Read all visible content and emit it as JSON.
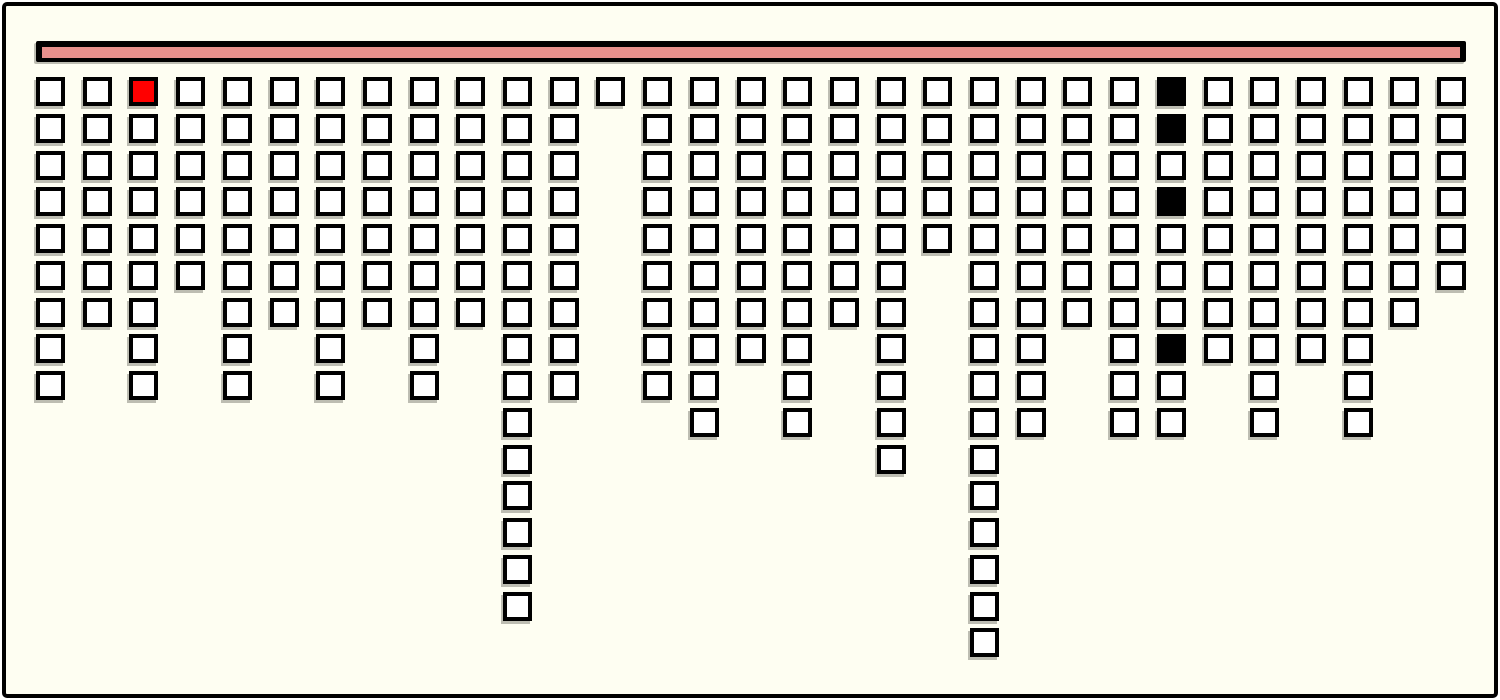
{
  "canvas": {
    "outer_background": "#FFFFFF",
    "panel_background": "#FEFEF2",
    "panel_border_color": "#000000"
  },
  "top_bar": {
    "fill_color": "#E8908C",
    "border_color": "#000000"
  },
  "grid": {
    "columns": 31,
    "max_rows": 16,
    "column_heights": [
      9,
      7,
      9,
      6,
      9,
      7,
      9,
      7,
      9,
      7,
      15,
      9,
      1,
      9,
      10,
      8,
      10,
      7,
      11,
      5,
      16,
      10,
      7,
      10,
      10,
      8,
      10,
      8,
      10,
      7,
      6
    ],
    "special_cells": [
      {
        "col": 3,
        "row": 1,
        "color": "red"
      },
      {
        "col": 25,
        "row": 1,
        "color": "black"
      },
      {
        "col": 25,
        "row": 2,
        "color": "black"
      },
      {
        "col": 25,
        "row": 4,
        "color": "black"
      },
      {
        "col": 25,
        "row": 8,
        "color": "black"
      }
    ],
    "cell_colors": {
      "default": "#FFFFFF",
      "red": "#FF0000",
      "black": "#000000"
    }
  },
  "chart_data": {
    "type": "bar",
    "title": "",
    "xlabel": "",
    "ylabel": "",
    "orientation": "columns hanging downward from top bar, one unit square per count",
    "categories": [
      "1",
      "2",
      "3",
      "4",
      "5",
      "6",
      "7",
      "8",
      "9",
      "10",
      "11",
      "12",
      "13",
      "14",
      "15",
      "16",
      "17",
      "18",
      "19",
      "20",
      "21",
      "22",
      "23",
      "24",
      "25",
      "26",
      "27",
      "28",
      "29",
      "30",
      "31"
    ],
    "values": [
      9,
      7,
      9,
      6,
      9,
      7,
      9,
      7,
      9,
      7,
      15,
      9,
      1,
      9,
      10,
      8,
      10,
      7,
      11,
      5,
      16,
      10,
      7,
      10,
      10,
      8,
      10,
      8,
      10,
      7,
      6
    ],
    "ylim": [
      0,
      16
    ],
    "grid": false,
    "legend": false,
    "annotations": [
      {
        "column": 3,
        "unit": 1,
        "color": "#FF0000",
        "meaning": "highlighted red square"
      },
      {
        "column": 25,
        "unit": 1,
        "color": "#000000",
        "meaning": "filled black square"
      },
      {
        "column": 25,
        "unit": 2,
        "color": "#000000",
        "meaning": "filled black square"
      },
      {
        "column": 25,
        "unit": 4,
        "color": "#000000",
        "meaning": "filled black square"
      },
      {
        "column": 25,
        "unit": 8,
        "color": "#000000",
        "meaning": "filled black square"
      }
    ]
  }
}
